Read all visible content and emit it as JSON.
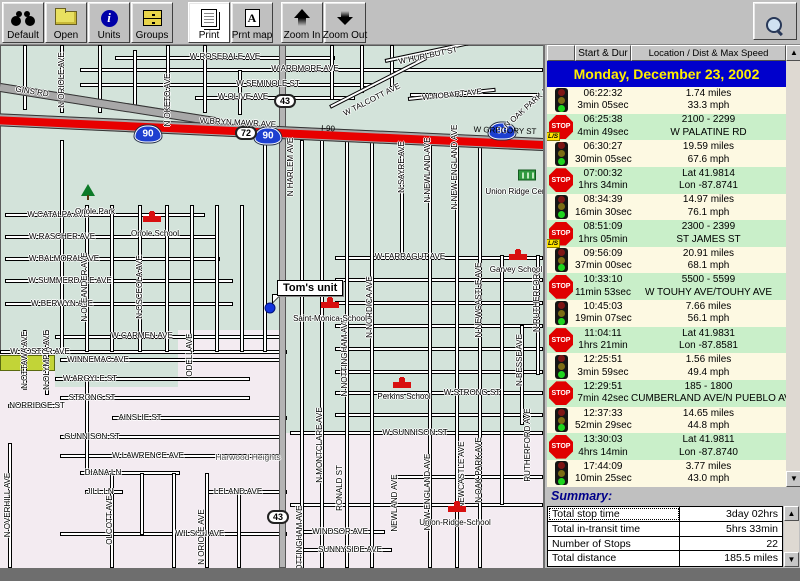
{
  "toolbar": {
    "buttons": [
      {
        "name": "default-button",
        "label": "Default",
        "icon": "binoculars",
        "x": 2
      },
      {
        "name": "open-button",
        "label": "Open",
        "icon": "folder",
        "x": 45
      },
      {
        "name": "units-button",
        "label": "Units",
        "icon": "info",
        "x": 88
      },
      {
        "name": "groups-button",
        "label": "Groups",
        "icon": "drawers",
        "x": 131
      },
      {
        "name": "print-button",
        "label": "Print",
        "icon": "print",
        "x": 188,
        "active": true
      },
      {
        "name": "print-map-button",
        "label": "Prnt map",
        "icon": "printmap",
        "x": 231
      },
      {
        "name": "zoom-in-button",
        "label": "Zoom In",
        "icon": "zoomin",
        "x": 281
      },
      {
        "name": "zoom-out-button",
        "label": "Zoom Out",
        "icon": "zoomout",
        "x": 324
      }
    ],
    "magnifier_icon": "magnifier"
  },
  "panel": {
    "columns": {
      "start_dur": "Start & Dur",
      "location": "Location / Dist & Max Speed"
    },
    "date_header": "Monday, December 23, 2002",
    "icon_text": {
      "stop": "STOP",
      "ls": "L/S"
    },
    "events": [
      {
        "icon": "light",
        "time": "06:22:32",
        "dur": "3min 05sec",
        "val1": "1.74 miles",
        "val2": "33.3 mph",
        "row": "transit"
      },
      {
        "icon": "stop",
        "badge": "L/S",
        "time": "06:25:38",
        "dur": "4min 49sec",
        "val1": "2100 - 2299",
        "val2": "W PALATINE RD",
        "row": "stop"
      },
      {
        "icon": "light",
        "time": "06:30:27",
        "dur": "30min 05sec",
        "val1": "19.59 miles",
        "val2": "67.6 mph",
        "row": "transit"
      },
      {
        "icon": "stop",
        "time": "07:00:32",
        "dur": "1hrs 34min",
        "val1": "Lat 41.9814",
        "val2": "Lon -87.8741",
        "row": "stop"
      },
      {
        "icon": "light",
        "time": "08:34:39",
        "dur": "16min 30sec",
        "val1": "14.97 miles",
        "val2": "76.1 mph",
        "row": "transit"
      },
      {
        "icon": "stop",
        "badge": "L/S",
        "time": "08:51:09",
        "dur": "1hrs 05min",
        "val1": "2300 - 2399",
        "val2": "ST JAMES ST",
        "row": "stop"
      },
      {
        "icon": "light",
        "time": "09:56:09",
        "dur": "37min 00sec",
        "val1": "20.91 miles",
        "val2": "68.1 mph",
        "row": "transit"
      },
      {
        "icon": "stop",
        "time": "10:33:10",
        "dur": "11min 53sec",
        "val1": "5500 - 5599",
        "val2": "W TOUHY AVE/TOUHY AVE",
        "row": "stop"
      },
      {
        "icon": "light",
        "time": "10:45:03",
        "dur": "19min 07sec",
        "val1": "7.66 miles",
        "val2": "56.1 mph",
        "row": "transit"
      },
      {
        "icon": "stop",
        "time": "11:04:11",
        "dur": "1hrs 21min",
        "val1": "Lat 41.9831",
        "val2": "Lon -87.8581",
        "row": "stop"
      },
      {
        "icon": "light",
        "time": "12:25:51",
        "dur": "3min 59sec",
        "val1": "1.56 miles",
        "val2": "49.4 mph",
        "row": "transit"
      },
      {
        "icon": "stop",
        "time": "12:29:51",
        "dur": "7min 42sec",
        "val1": "185 - 1800",
        "val2": "CUMBERLAND AVE/N PUEBLO AV",
        "row": "stop"
      },
      {
        "icon": "light",
        "time": "12:37:33",
        "dur": "52min 29sec",
        "val1": "14.65 miles",
        "val2": "44.8 mph",
        "row": "transit"
      },
      {
        "icon": "stop",
        "time": "13:30:03",
        "dur": "4hrs 14min",
        "val1": "Lat 41.9811",
        "val2": "Lon -87.8740",
        "row": "stop"
      },
      {
        "icon": "light",
        "time": "17:44:09",
        "dur": "10min 25sec",
        "val1": "3.77 miles",
        "val2": "43.0 mph",
        "row": "transit"
      }
    ],
    "summary": {
      "title": "Summary:",
      "rows": [
        {
          "label": "Total stop time",
          "value": "3day 02hrs"
        },
        {
          "label": "Total in-transit time",
          "value": "5hrs 33min"
        },
        {
          "label": "Number of Stops",
          "value": "22"
        },
        {
          "label": "Total distance",
          "value": "185.5 miles"
        }
      ]
    }
  },
  "map": {
    "unit": {
      "label": "Tom's unit"
    },
    "shields": [
      {
        "kind": "interstate",
        "text": "90",
        "x": 148,
        "y": 89
      },
      {
        "kind": "interstate",
        "text": "90",
        "x": 268,
        "y": 91
      },
      {
        "kind": "interstate",
        "text": "90",
        "x": 502,
        "y": 86
      },
      {
        "kind": "route",
        "text": "72",
        "x": 246,
        "y": 88
      },
      {
        "kind": "route",
        "text": "43",
        "x": 285,
        "y": 56
      },
      {
        "kind": "route",
        "text": "43",
        "x": 278,
        "y": 472
      }
    ],
    "pois": [
      {
        "type": "tree",
        "label": "Oriole Park",
        "ix": 88,
        "iy": 147,
        "lx": 95,
        "ly": 167
      },
      {
        "type": "school",
        "label": "Oriole  School",
        "ix": 152,
        "iy": 171,
        "lx": 155,
        "ly": 189
      },
      {
        "type": "school",
        "label": "Saint-Monica-School",
        "ix": 330,
        "iy": 257,
        "lx": 330,
        "ly": 274
      },
      {
        "type": "school",
        "label": "Perkins  School",
        "ix": 402,
        "iy": 337,
        "lx": 404,
        "ly": 352
      },
      {
        "type": "school",
        "label": "Garvey  School",
        "ix": 518,
        "iy": 209,
        "lx": 516,
        "ly": 225
      },
      {
        "type": "school",
        "label": "Union-Ridge-School",
        "ix": 457,
        "iy": 461,
        "lx": 455,
        "ly": 478
      },
      {
        "type": "cemetery",
        "label": "Union Ridge Cem",
        "ix": 527,
        "iy": 130,
        "lx": 517,
        "ly": 147
      }
    ],
    "labels": [
      {
        "t": "W ROSEDALE AVE",
        "x": 225,
        "y": 12
      },
      {
        "t": "W ARDMORE AVE",
        "x": 305,
        "y": 24
      },
      {
        "t": "W SEMINOLE ST",
        "x": 268,
        "y": 39
      },
      {
        "t": "W OLIVE AVE",
        "x": 243,
        "y": 52
      },
      {
        "t": "GINS RD",
        "x": 32,
        "y": 47,
        "r": 9
      },
      {
        "t": "W BRYN MAWR AVE",
        "x": 238,
        "y": 78,
        "r": 3
      },
      {
        "t": "I-90",
        "x": 328,
        "y": 84,
        "r": 3,
        "cls": "onroad"
      },
      {
        "t": "W GREGORY ST",
        "x": 505,
        "y": 86,
        "r": 2,
        "cls": "onroad"
      },
      {
        "t": "W CATALPA AVE",
        "x": 58,
        "y": 170
      },
      {
        "t": "W RASCHER AVE",
        "x": 62,
        "y": 192
      },
      {
        "t": "W BALMORAL AVE",
        "x": 64,
        "y": 214
      },
      {
        "t": "W SUMMERDALE AVE",
        "x": 70,
        "y": 236
      },
      {
        "t": "W BERWYN AVE",
        "x": 62,
        "y": 259
      },
      {
        "t": "W FOSTER AVE",
        "x": 40,
        "y": 307
      },
      {
        "t": "W CARMEN AVE",
        "x": 142,
        "y": 291
      },
      {
        "t": "WINNEMAC AVE",
        "x": 98,
        "y": 315
      },
      {
        "t": "W ARGYLE ST",
        "x": 90,
        "y": 334
      },
      {
        "t": "STRONG ST",
        "x": 92,
        "y": 353
      },
      {
        "t": "NORRIDGE ST",
        "x": 37,
        "y": 361
      },
      {
        "t": "AINSLIE ST",
        "x": 140,
        "y": 373
      },
      {
        "t": "GUNNISON ST",
        "x": 92,
        "y": 392
      },
      {
        "t": "W LAWRENCE AVE",
        "x": 148,
        "y": 411
      },
      {
        "t": "DIANA LN",
        "x": 103,
        "y": 428
      },
      {
        "t": "JILL LN",
        "x": 100,
        "y": 447
      },
      {
        "t": "LELAND AVE",
        "x": 238,
        "y": 447
      },
      {
        "t": "WILSON AVE",
        "x": 200,
        "y": 489
      },
      {
        "t": "WINDSOR AVE",
        "x": 340,
        "y": 487
      },
      {
        "t": "SUNNYSIDE AVE",
        "x": 350,
        "y": 505
      },
      {
        "t": "W GUNNISON ST",
        "x": 415,
        "y": 388
      },
      {
        "t": "W FARRAGUT AVE",
        "x": 410,
        "y": 212
      },
      {
        "t": "W STRONG ST",
        "x": 472,
        "y": 348
      },
      {
        "t": "W TALCOTT AVE",
        "x": 372,
        "y": 55,
        "r": -27
      },
      {
        "t": "W HURLBUT ST",
        "x": 428,
        "y": 11,
        "r": -12
      },
      {
        "t": "W HOBART AVE",
        "x": 452,
        "y": 50,
        "r": -6
      },
      {
        "t": "Harwood Heights",
        "x": 248,
        "y": 412,
        "cls": "place"
      },
      {
        "t": "N ORIOLE AVE",
        "x": 62,
        "y": 35,
        "v": 1
      },
      {
        "t": "N OKETO AVE",
        "x": 168,
        "y": 55,
        "v": 1
      },
      {
        "t": "N HARLEM AVE",
        "x": 291,
        "y": 122,
        "v": 1
      },
      {
        "t": "N OLEANDER AVE",
        "x": 85,
        "y": 242,
        "v": 1
      },
      {
        "t": "N OSCEOLA AVE",
        "x": 140,
        "y": 242,
        "v": 1
      },
      {
        "t": "N OTTAWA AVE",
        "x": 25,
        "y": 315,
        "v": 1
      },
      {
        "t": "N OLYMPIA AVE",
        "x": 47,
        "y": 315,
        "v": 1
      },
      {
        "t": "ODELL AVE",
        "x": 190,
        "y": 310,
        "v": 1
      },
      {
        "t": "N OVERHILL AVE",
        "x": 8,
        "y": 460,
        "v": 1
      },
      {
        "t": "OLCOTT AVE",
        "x": 110,
        "y": 475,
        "v": 1
      },
      {
        "t": "N ORIOLE AVE",
        "x": 202,
        "y": 492,
        "v": 1
      },
      {
        "t": "N MONTCLARE AVE",
        "x": 320,
        "y": 400,
        "v": 1
      },
      {
        "t": "RONALD ST",
        "x": 340,
        "y": 443,
        "v": 1
      },
      {
        "t": "NEWLAND AVE",
        "x": 395,
        "y": 458,
        "v": 1
      },
      {
        "t": "NEW ENGLAND AVE",
        "x": 428,
        "y": 447,
        "v": 1
      },
      {
        "t": "NEWCASTLE AVE",
        "x": 462,
        "y": 430,
        "v": 1
      },
      {
        "t": "N OAK PARK AVE",
        "x": 479,
        "y": 425,
        "v": 1
      },
      {
        "t": "N NOTTINGHAM AVE",
        "x": 345,
        "y": 312,
        "v": 1
      },
      {
        "t": "N NOTTINGHAM AVE",
        "x": 300,
        "y": 500,
        "v": 1
      },
      {
        "t": "N NORDICA AVE",
        "x": 370,
        "y": 262,
        "v": 1
      },
      {
        "t": "N SAYRE AVE",
        "x": 402,
        "y": 122,
        "v": 1
      },
      {
        "t": "N NEWLAND AVE",
        "x": 428,
        "y": 125,
        "v": 1
      },
      {
        "t": "N NEW ENGLAND AVE",
        "x": 455,
        "y": 122,
        "v": 1
      },
      {
        "t": "N NEWCASTLE AVE",
        "x": 479,
        "y": 255,
        "v": 1
      },
      {
        "t": "N RUTHERFORD",
        "x": 537,
        "y": 255,
        "v": 1
      },
      {
        "t": "RUTHERFORD AVE",
        "x": 528,
        "y": 400,
        "v": 1
      },
      {
        "t": "N BESSE AVE",
        "x": 520,
        "y": 315,
        "v": 1
      },
      {
        "t": "N OAK PARK AVE",
        "x": 530,
        "y": 60,
        "r": -42
      }
    ]
  },
  "colors": {
    "date_bar": "#0000cc",
    "date_text": "#ffee00",
    "transit_row": "#fdf9e2",
    "stop_row": "#c9efc9",
    "stop_sign": "#e00000",
    "ls_badge": "#ffe400",
    "summary_title": "#00008a",
    "expressway": "#e80000",
    "interstate_shield": "#1d3fd0",
    "map_green": "#d3e3da",
    "map_pink": "#f3ebf1",
    "chrome": "#c0c0c0"
  }
}
